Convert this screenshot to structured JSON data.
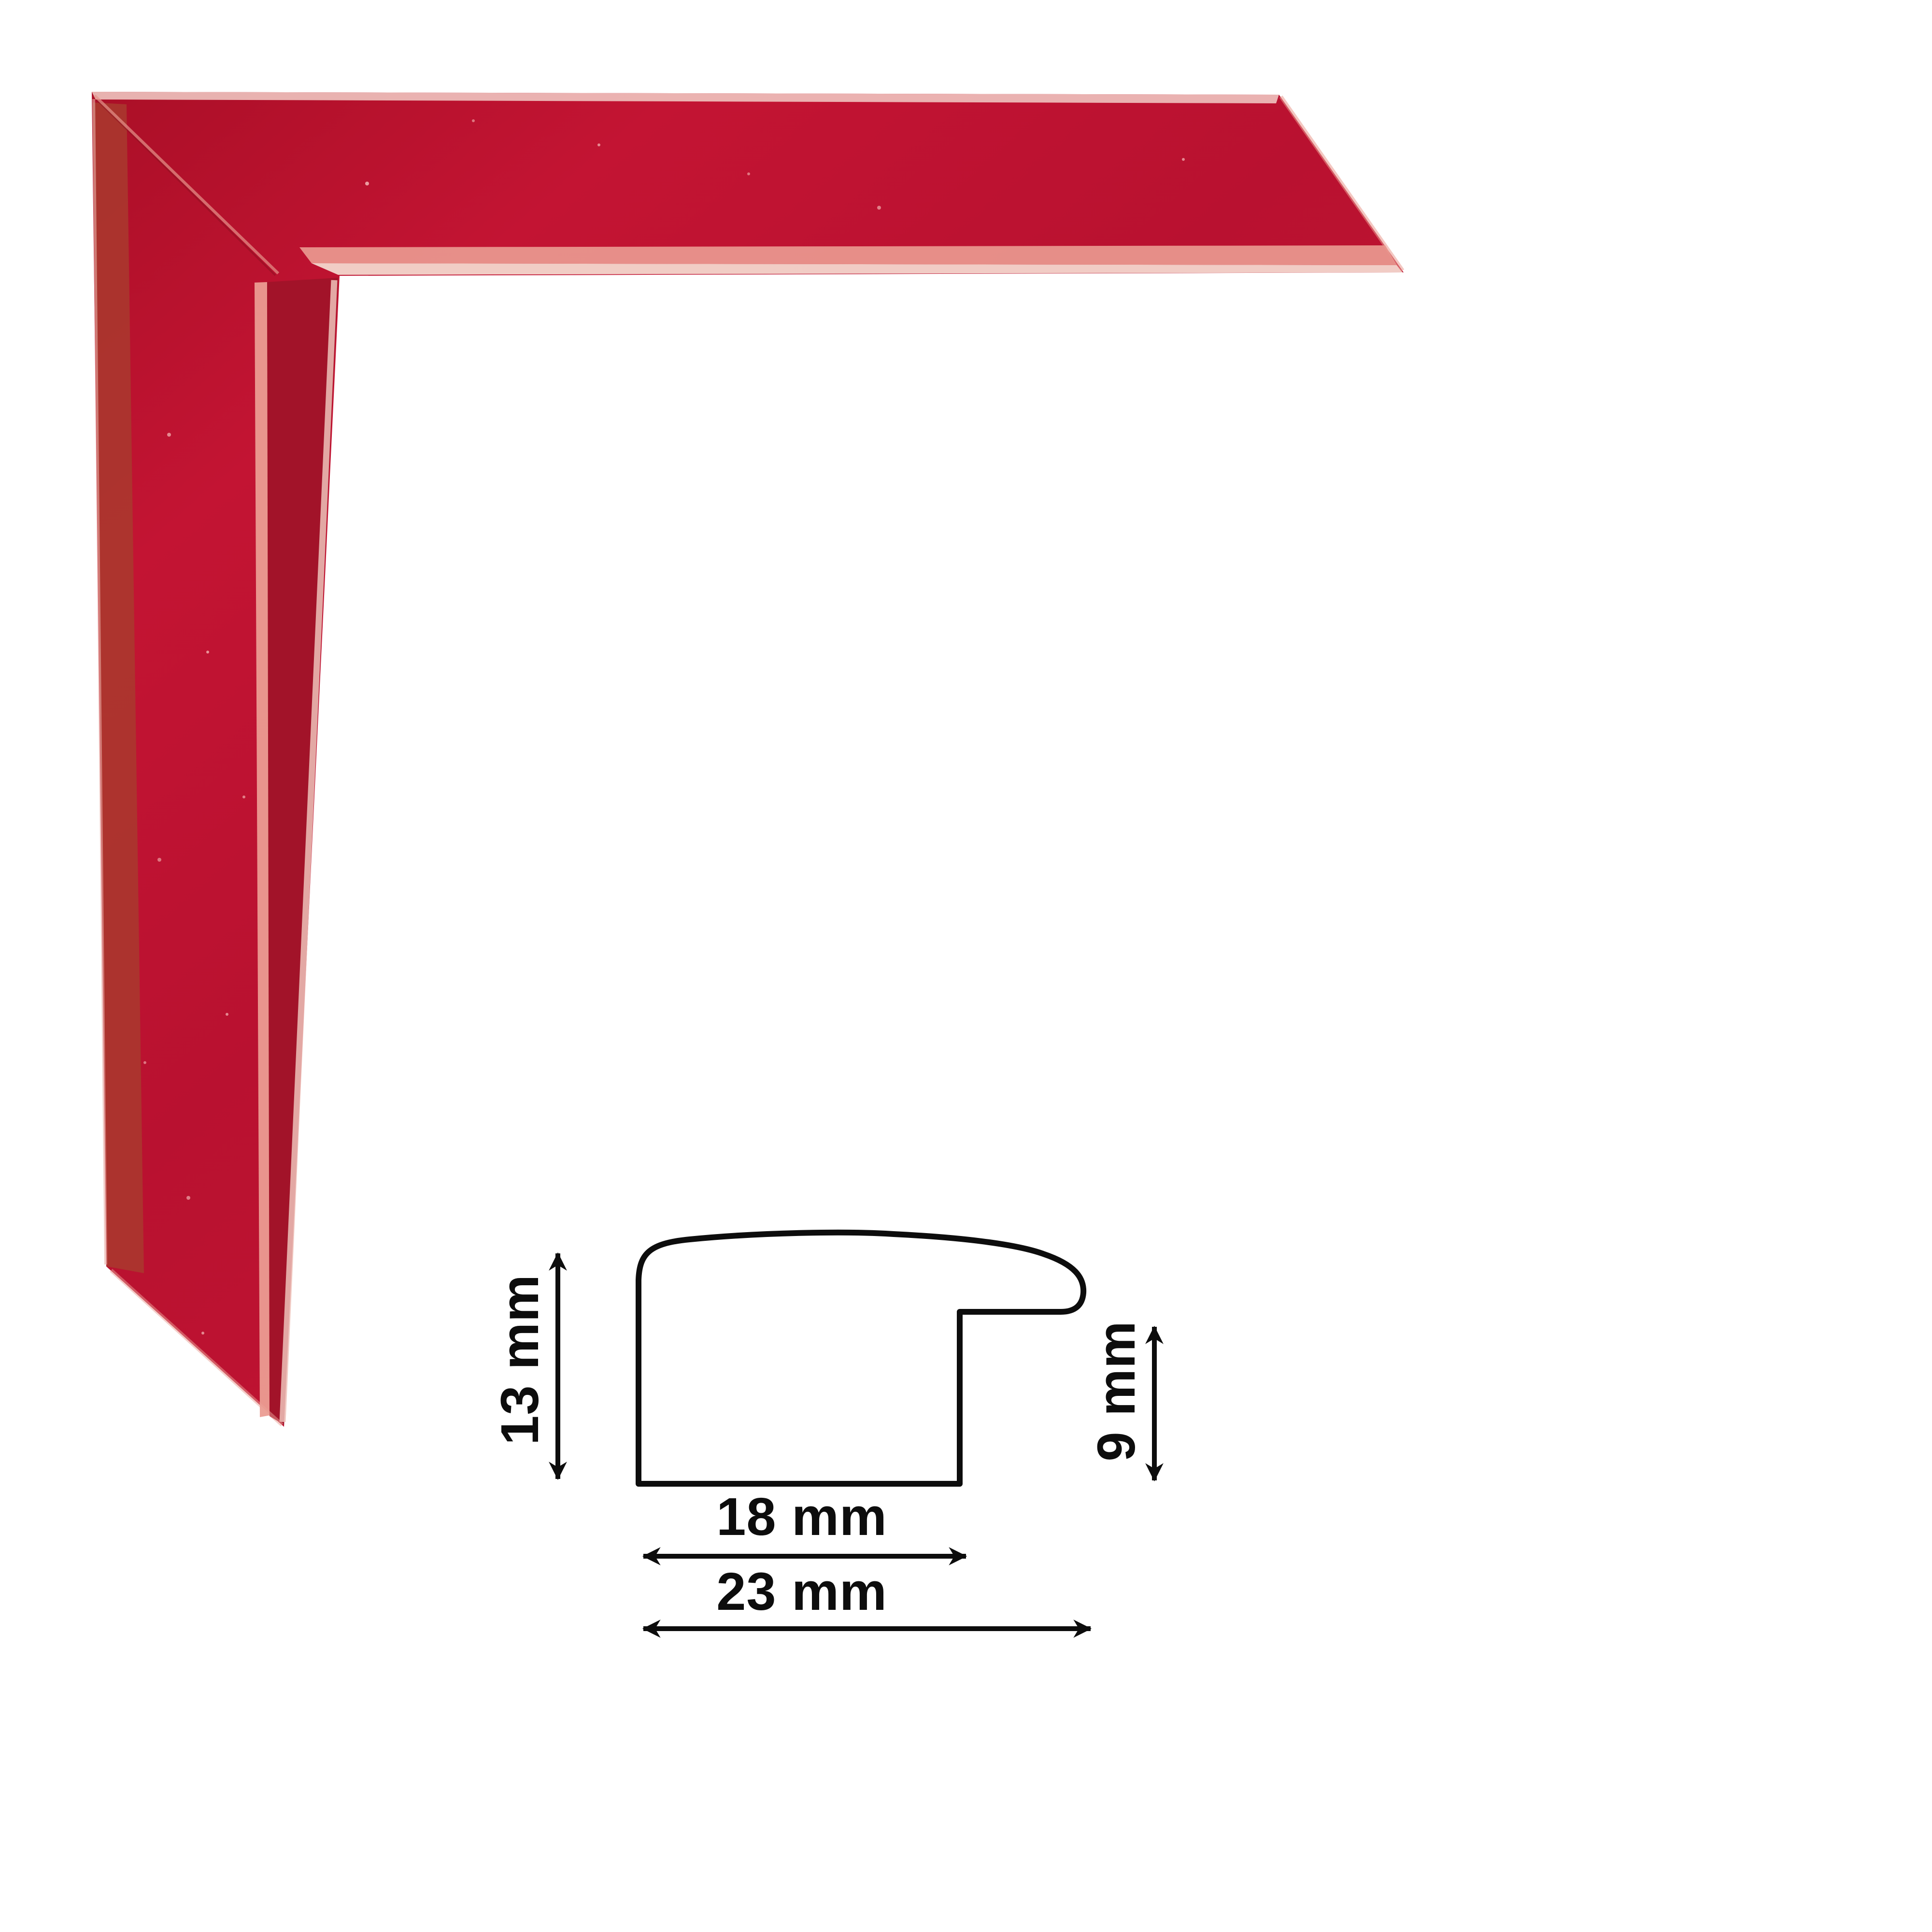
{
  "page": {
    "background": "#ffffff",
    "description": "Red picture-frame moulding corner sample with dimensioned cross-section drawing"
  },
  "product_photo": {
    "name": "red-frame-corner-sample",
    "main_color": "#bb1230",
    "dark_color": "#a30f26",
    "side_face_color": "#a21329",
    "dull_band_color": "#a93a2e",
    "specular_color": "#eb9c92",
    "edge_light_color": "#f3d7cd"
  },
  "diagram": {
    "stroke_color": "#0d0d0d",
    "labels": {
      "height": "13 mm",
      "rabbet_height": "9 mm",
      "face_width": "18 mm",
      "total_width": "23 mm"
    },
    "dimensions_mm": {
      "height": 13,
      "rabbet_height": 9,
      "face_width": 18,
      "total_width": 23
    }
  }
}
